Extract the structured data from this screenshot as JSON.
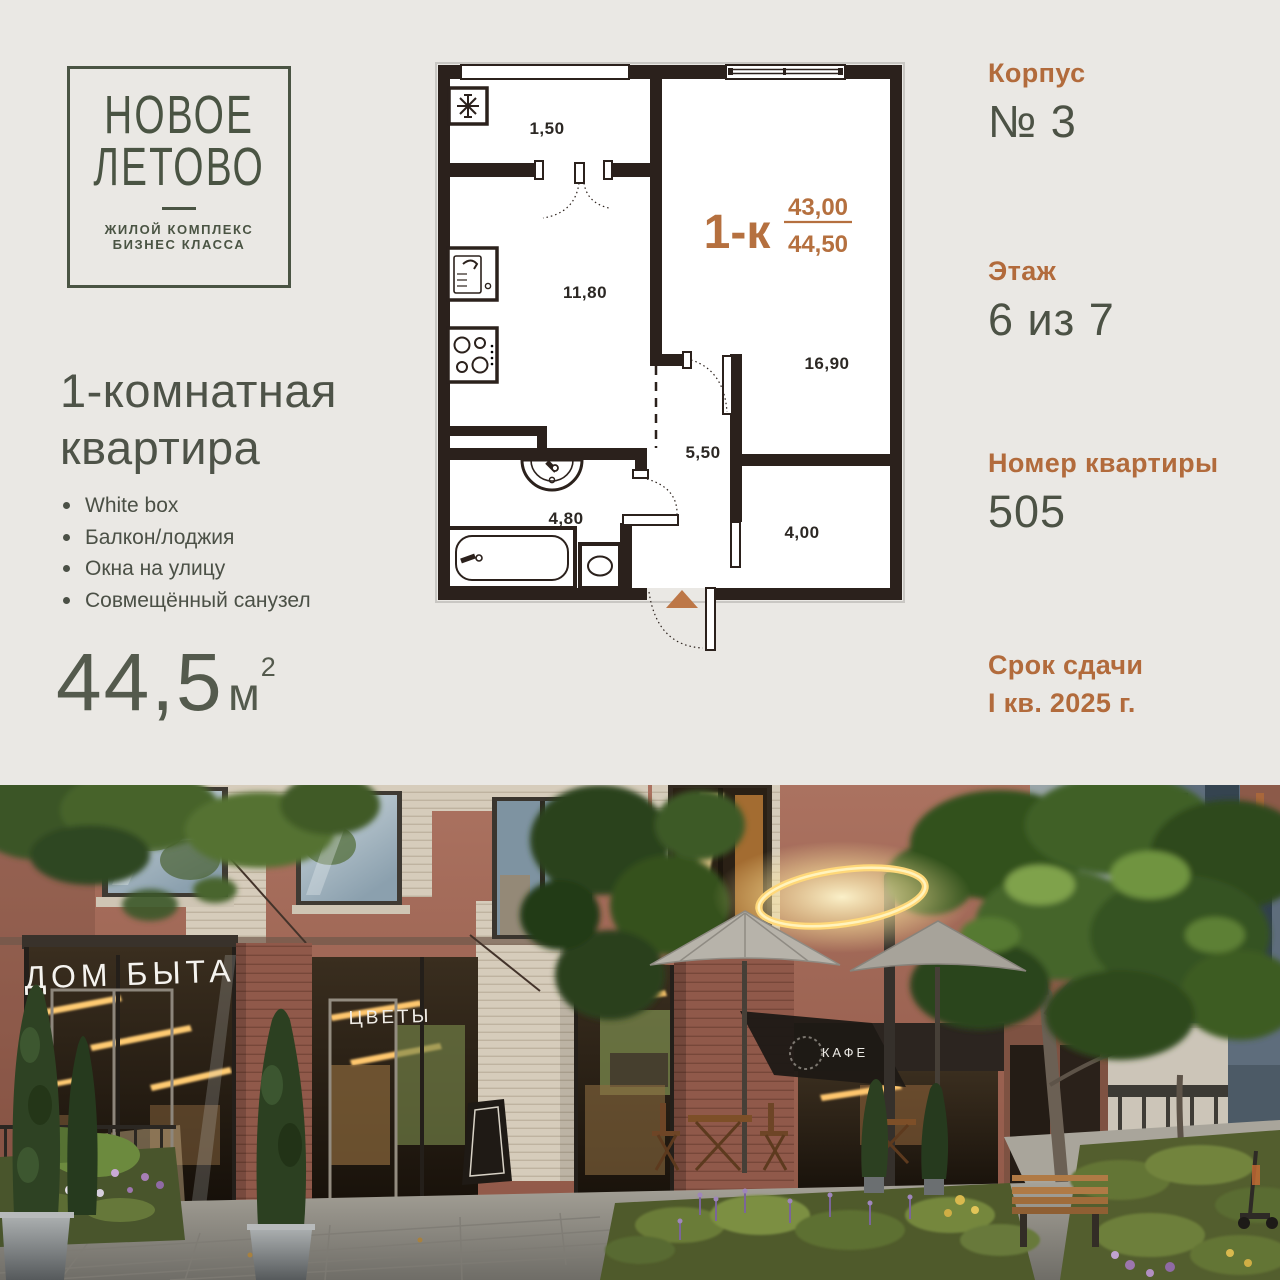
{
  "logo": {
    "title_line1": "НОВОЕ",
    "title_line2": "ЛЕТОВО",
    "subtitle_line1": "ЖИЛОЙ КОМПЛЕКС",
    "subtitle_line2": "БИЗНЕС КЛАССА"
  },
  "listing": {
    "title_line1": "1-комнатная",
    "title_line2": "квартира",
    "features": [
      "White box",
      "Балкон/лоджия",
      "Окна на улицу",
      "Совмещённый санузел"
    ],
    "area_value": "44,5",
    "area_unit": "м",
    "area_sup": "2"
  },
  "plan": {
    "type_label": "1-к",
    "area_living": "43,00",
    "area_total": "44,50",
    "rooms": [
      {
        "name": "balcony",
        "area": "1,50"
      },
      {
        "name": "kitchen",
        "area": "11,80"
      },
      {
        "name": "living-room",
        "area": "16,90"
      },
      {
        "name": "hall",
        "area": "5,50"
      },
      {
        "name": "bathroom",
        "area": "4,80"
      },
      {
        "name": "wardrobe",
        "area": "4,00"
      }
    ]
  },
  "details": [
    {
      "label": "Корпус",
      "value": "№ 3"
    },
    {
      "label": "Этаж",
      "value": "6 из 7"
    },
    {
      "label": "Номер квартиры",
      "value": "505"
    }
  ],
  "deadline": {
    "label": "Срок сдачи",
    "value": "I кв. 2025 г."
  },
  "photo": {
    "signs": [
      "ДОМ БЫТА",
      "ЦВЕТЫ",
      "КАФЕ"
    ]
  },
  "colors": {
    "accent": "#b26b3c",
    "text_green": "#4c5245",
    "plan_wall": "#2b211c",
    "background": "#eae8e4"
  }
}
